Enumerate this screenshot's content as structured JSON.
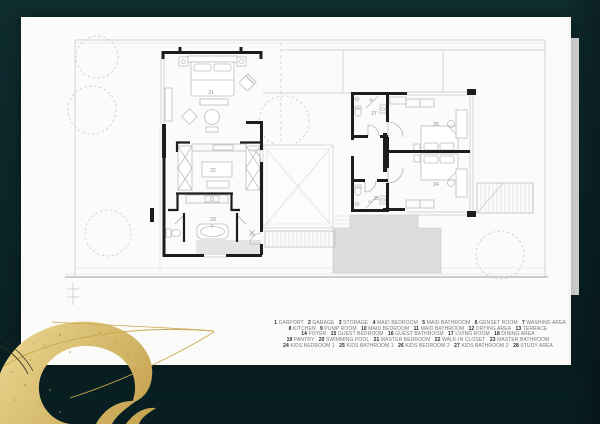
{
  "palette": {
    "background_top": "#0f2c2f",
    "background_bottom": "#081e21",
    "card": "#fbfbfa",
    "wall": "#1d1d1d",
    "light_line": "#c6c6c6",
    "pool": "#dcdcdc",
    "gold": "#d2b264",
    "gold_light": "#e9d590",
    "gold_dark": "#c7a452"
  },
  "plan": {
    "rooms": [
      {
        "num": "21",
        "name": "MASTER BEDROOM"
      },
      {
        "num": "22",
        "name": "WALK-IN CLOSET"
      },
      {
        "num": "23",
        "name": "MASTER BATHROOM"
      },
      {
        "num": "24",
        "name": "KIDS BEDROOM 1"
      },
      {
        "num": "25",
        "name": "KIDS BATHROOM 1"
      },
      {
        "num": "26",
        "name": "KIDS BEDROOM 2"
      },
      {
        "num": "27",
        "name": "KIDS BATHROOM 2"
      }
    ]
  },
  "legend": {
    "lines": [
      [
        {
          "n": "1",
          "label": "CARPORT"
        },
        {
          "n": "2",
          "label": "GARAGE"
        },
        {
          "n": "3",
          "label": "STORAGE"
        },
        {
          "n": "4",
          "label": "MAID BEDROOM"
        },
        {
          "n": "5",
          "label": "MAID BATHROOM"
        },
        {
          "n": "6",
          "label": "GENSET ROOM"
        },
        {
          "n": "7",
          "label": "WASHING AREA"
        }
      ],
      [
        {
          "n": "8",
          "label": "KITCHEN"
        },
        {
          "n": "9",
          "label": "PUMP ROOM"
        },
        {
          "n": "10",
          "label": "MAID BEDROOM"
        },
        {
          "n": "11",
          "label": "MAID BATHROOM"
        },
        {
          "n": "12",
          "label": "DRYING AREA"
        },
        {
          "n": "13",
          "label": "TERRACE"
        }
      ],
      [
        {
          "n": "14",
          "label": "FOYER"
        },
        {
          "n": "15",
          "label": "GUEST BEDROOM"
        },
        {
          "n": "16",
          "label": "GUEST BATHROOM"
        },
        {
          "n": "17",
          "label": "LIVING ROOM"
        },
        {
          "n": "18",
          "label": "DINING AREA"
        }
      ],
      [
        {
          "n": "19",
          "label": "PANTRY"
        },
        {
          "n": "20",
          "label": "SWIMMING POOL"
        },
        {
          "n": "21",
          "label": "MASTER BEDROOM"
        },
        {
          "n": "22",
          "label": "WALK-IN CLOSET"
        },
        {
          "n": "23",
          "label": "MASTER BATHROOM"
        }
      ],
      [
        {
          "n": "24",
          "label": "KIDS BEDROOM 1"
        },
        {
          "n": "25",
          "label": "KIDS BATHROOM 1"
        },
        {
          "n": "26",
          "label": "KIDS BEDROOM 2"
        },
        {
          "n": "27",
          "label": "KIDS BATHROOM 2"
        },
        {
          "n": "28",
          "label": "STUDY AREA"
        }
      ]
    ]
  }
}
